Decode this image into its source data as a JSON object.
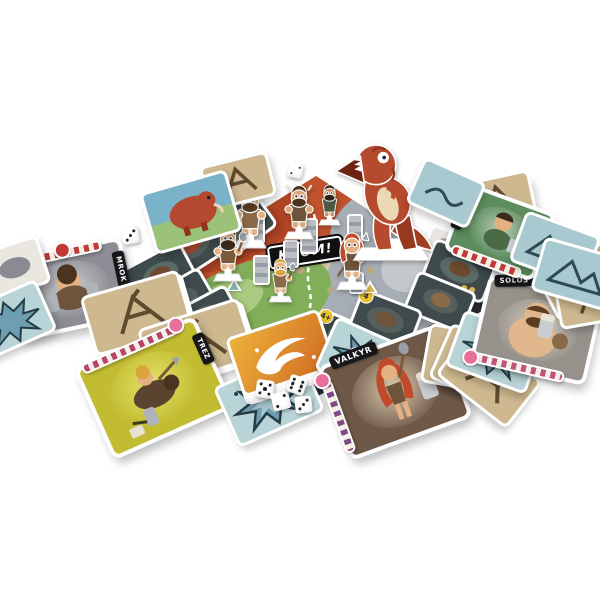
{
  "scene": {
    "background": "#ffffff"
  },
  "board": {
    "logo_text": "KROM!",
    "colors": {
      "sand": "#d5c8a2",
      "lava": "#c1522e",
      "meadow": "#83ae59",
      "stone": "#a6adb4",
      "water": "#8ab5a9",
      "edge": "#23262b"
    }
  },
  "pieces": {
    "trex_color": "#b54a2f",
    "dice": {
      "color": "#ffffff",
      "pip_color": "#222222",
      "values": [
        2,
        3,
        5,
        2,
        6,
        3
      ]
    }
  },
  "player_cards": {
    "mrok": {
      "name": "MROK",
      "bg": "#8d8d95"
    },
    "trez": {
      "name": "TREZ",
      "bg": "#c2bc32"
    },
    "valkyr": {
      "name": "VALKYR",
      "side_label": "72 BC",
      "bg": "#6e5848"
    },
    "solos": {
      "name": "SOLOS",
      "bg": "#96918b"
    },
    "dak_ta": {
      "name": "DAK TA",
      "bg": "#5d8d5e"
    }
  },
  "badges": {
    "hunt_a": "4+",
    "hunt_b": "4"
  }
}
